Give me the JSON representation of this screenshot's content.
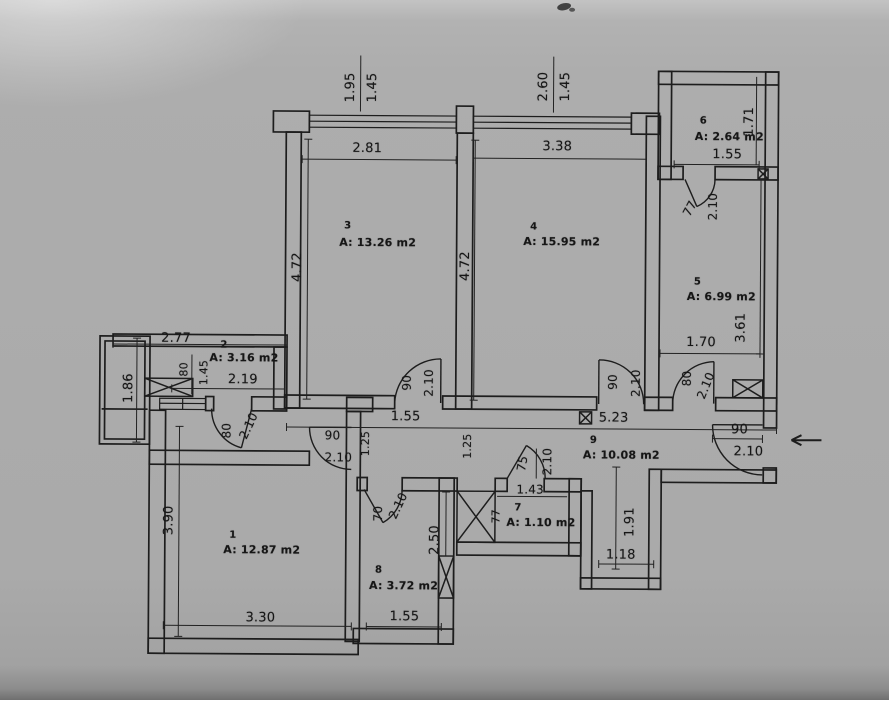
{
  "document": {
    "kind": "scanned architectural floor plan",
    "units": "m"
  },
  "canvas": {
    "width": 889,
    "height": 700,
    "paper_color": "#ababab",
    "ink_color": "#1c1c1c"
  },
  "rooms": [
    {
      "number": "1",
      "area": "A: 12.87 m2",
      "num_pos": [
        234,
        537
      ],
      "area_pos": [
        263,
        551
      ]
    },
    {
      "number": "2",
      "area": "A: 3.16 m2",
      "num_pos": [
        224,
        347
      ],
      "area_pos": [
        244,
        359
      ]
    },
    {
      "number": "3",
      "area": "A: 13.26 m2",
      "num_pos": [
        347,
        227
      ],
      "area_pos": [
        377,
        243
      ]
    },
    {
      "number": "4",
      "area": "A: 15.95 m2",
      "num_pos": [
        533,
        227
      ],
      "area_pos": [
        561,
        241
      ]
    },
    {
      "number": "5",
      "area": "A: 6.99 m2",
      "num_pos": [
        697,
        281
      ],
      "area_pos": [
        721,
        295
      ]
    },
    {
      "number": "6",
      "area": "A: 2.64 m2",
      "num_pos": [
        702,
        120
      ],
      "area_pos": [
        728,
        135
      ]
    },
    {
      "number": "7",
      "area": "A: 1.10 m2",
      "num_pos": [
        519,
        508
      ],
      "area_pos": [
        542,
        522
      ]
    },
    {
      "number": "8",
      "area": "A: 3.72 m2",
      "num_pos": [
        380,
        571
      ],
      "area_pos": [
        405,
        586
      ]
    },
    {
      "number": "9",
      "area": "A: 10.08 m2",
      "num_pos": [
        594,
        440
      ],
      "area_pos": [
        622,
        454
      ]
    }
  ],
  "dimensions": [
    {
      "text": "1.95",
      "pos": [
        349,
        88
      ],
      "rot": -90
    },
    {
      "text": "1.45",
      "pos": [
        371,
        88
      ],
      "rot": -90
    },
    {
      "text": "2.60",
      "pos": [
        542,
        86
      ],
      "rot": -90
    },
    {
      "text": "1.45",
      "pos": [
        564,
        86
      ],
      "rot": -90
    },
    {
      "text": "2.81",
      "pos": [
        366,
        149
      ]
    },
    {
      "text": "3.38",
      "pos": [
        556,
        146
      ]
    },
    {
      "text": "1.55",
      "pos": [
        726,
        153
      ]
    },
    {
      "text": "1.71",
      "pos": [
        748,
        120
      ],
      "rot": -90
    },
    {
      "text": "2.77",
      "pos": [
        176,
        340
      ]
    },
    {
      "text": "1.86",
      "pos": [
        129,
        390
      ],
      "rot": -90
    },
    {
      "text": "80",
      "pos": [
        184,
        371
      ],
      "rot": -90,
      "size": 11
    },
    {
      "text": "1.45",
      "pos": [
        204,
        374
      ],
      "rot": -90,
      "size": 11
    },
    {
      "text": "2.19",
      "pos": [
        243,
        381
      ]
    },
    {
      "text": "4.72",
      "pos": [
        297,
        268
      ],
      "rot": -90
    },
    {
      "text": "4.72",
      "pos": [
        465,
        266
      ],
      "rot": -90
    },
    {
      "text": "1.70",
      "pos": [
        701,
        341
      ]
    },
    {
      "text": "3.61",
      "pos": [
        741,
        326
      ],
      "rot": -90
    },
    {
      "text": "1.55",
      "pos": [
        406,
        417
      ]
    },
    {
      "text": "5.23",
      "pos": [
        614,
        417
      ]
    },
    {
      "text": "1.25",
      "pos": [
        366,
        444
      ],
      "rot": -90,
      "size": 11
    },
    {
      "text": "1.25",
      "pos": [
        468,
        446
      ],
      "rot": -90,
      "size": 11
    },
    {
      "text": "3.90",
      "pos": [
        170,
        522
      ],
      "rot": -90
    },
    {
      "text": "3.30",
      "pos": [
        262,
        619
      ]
    },
    {
      "text": "1.55",
      "pos": [
        406,
        617
      ]
    },
    {
      "text": "2.50",
      "pos": [
        436,
        540
      ],
      "rot": -90
    },
    {
      "text": "1.43",
      "pos": [
        531,
        489
      ],
      "size": 12
    },
    {
      "text": "1.91",
      "pos": [
        631,
        521
      ],
      "rot": -90
    },
    {
      "text": "1.18",
      "pos": [
        622,
        554
      ]
    },
    {
      "text": "77",
      "pos": [
        497,
        516
      ],
      "rot": -90,
      "size": 11
    },
    {
      "text": "90",
      "pos": [
        740,
        428
      ]
    },
    {
      "text": "2.10",
      "pos": [
        749,
        450
      ]
    }
  ],
  "door_labels": [
    {
      "text": "90",
      "pos": [
        407,
        383
      ],
      "rot": -90
    },
    {
      "text": "2.10",
      "pos": [
        429,
        383
      ],
      "rot": -90
    },
    {
      "text": "90",
      "pos": [
        613,
        381
      ],
      "rot": -90
    },
    {
      "text": "2.10",
      "pos": [
        636,
        382
      ],
      "rot": -90
    },
    {
      "text": "80",
      "pos": [
        687,
        377
      ],
      "rot": -90
    },
    {
      "text": "2.10",
      "pos": [
        706,
        384
      ],
      "rot": -68
    },
    {
      "text": "77",
      "pos": [
        689,
        207
      ],
      "rot": -62
    },
    {
      "text": "2.10",
      "pos": [
        712,
        205
      ],
      "rot": -90
    },
    {
      "text": "80",
      "pos": [
        227,
        432
      ],
      "rot": -90
    },
    {
      "text": "2.10",
      "pos": [
        249,
        427
      ],
      "rot": -65
    },
    {
      "text": "90",
      "pos": [
        333,
        436
      ]
    },
    {
      "text": "2.10",
      "pos": [
        339,
        458
      ]
    },
    {
      "text": "70",
      "pos": [
        379,
        514
      ],
      "rot": -90
    },
    {
      "text": "2.10",
      "pos": [
        399,
        506
      ],
      "rot": -65
    },
    {
      "text": "75",
      "pos": [
        523,
        463
      ],
      "rot": -80
    },
    {
      "text": "2.10",
      "pos": [
        548,
        461
      ],
      "rot": -90
    }
  ],
  "entrance": {
    "door_width": "90",
    "door_height": "2.10",
    "arrow_direction": "left"
  }
}
